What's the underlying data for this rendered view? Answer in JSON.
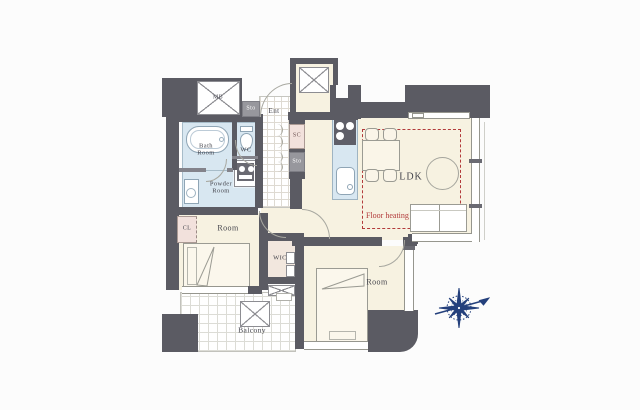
{
  "plan": {
    "labels": {
      "meter_box": "MB",
      "storage_entry": "Sto",
      "entrance": "Ent",
      "shoe_closet": "SC",
      "storage_hall": "Sto",
      "toilet": "WC",
      "bath_line1": "Bath",
      "bath_line2": "Room",
      "powder_line1": "Powder",
      "powder_line2": "Room",
      "closet": "CL",
      "bedroom_west": "Room",
      "walk_in_closet": "WIC",
      "ldk": "LDK",
      "floor_heating": "Floor heating",
      "bedroom_south": "Room",
      "balcony": "Balcony"
    },
    "colors": {
      "wall": "#5b5b63",
      "floor": "#f7f2e1",
      "wet_area": "#d8e7f1",
      "closet_pink": "#f2e1dc",
      "storage_gray": "#97979d",
      "floor_heating_red": "#b23a3a",
      "compass_navy": "#24407c"
    }
  }
}
